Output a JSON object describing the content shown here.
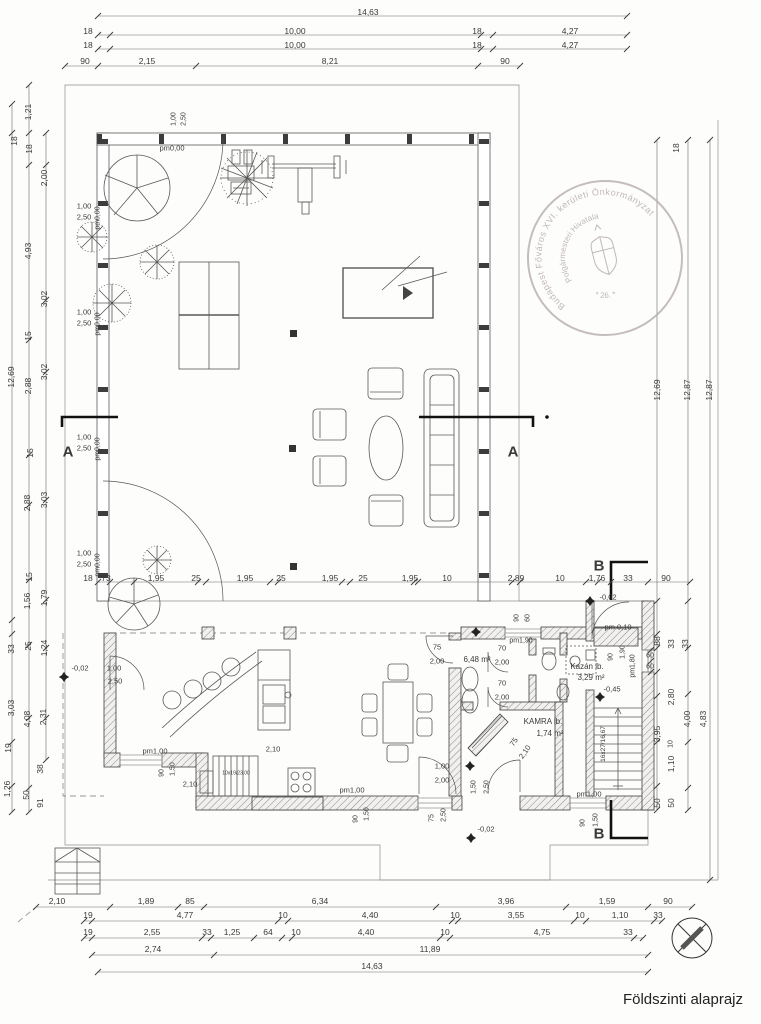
{
  "title": "Földszinti alaprajz",
  "stamp": {
    "ring_text": "Budapest Főváros XVI. kerületi Önkormányzat",
    "inner_text": "Polgármesteri Hivatala",
    "bottom_text": "* 26. *"
  },
  "rooms": {
    "bathroom_area": "6,48 m²",
    "boiler_label": "Kazán lb.",
    "boiler_area": "3,29 m²",
    "pantry_label": "KAMRA lb.",
    "pantry_area": "1,74 m²",
    "stair_main": "16x27/16,67",
    "stair_small": "10x19/23,00"
  },
  "labels": [
    {
      "t": "14,63",
      "x": 368,
      "y": 12
    },
    {
      "t": "18",
      "x": 88,
      "y": 31
    },
    {
      "t": "10,00",
      "x": 295,
      "y": 31
    },
    {
      "t": "18",
      "x": 477,
      "y": 31
    },
    {
      "t": "4,27",
      "x": 570,
      "y": 31
    },
    {
      "t": "18",
      "x": 88,
      "y": 45
    },
    {
      "t": "10,00",
      "x": 295,
      "y": 45
    },
    {
      "t": "18",
      "x": 477,
      "y": 45
    },
    {
      "t": "4,27",
      "x": 570,
      "y": 45
    },
    {
      "t": "90",
      "x": 85,
      "y": 61
    },
    {
      "t": "2,15",
      "x": 147,
      "y": 61
    },
    {
      "t": "8,21",
      "x": 330,
      "y": 61
    },
    {
      "t": "90",
      "x": 505,
      "y": 61
    },
    {
      "t": "1,21",
      "x": 28,
      "y": 112,
      "r": -90
    },
    {
      "t": "18",
      "x": 14,
      "y": 141,
      "r": -90
    },
    {
      "t": "18",
      "x": 29,
      "y": 149,
      "r": -90
    },
    {
      "t": "2,00",
      "x": 44,
      "y": 178,
      "r": -90
    },
    {
      "t": "4,93",
      "x": 28,
      "y": 251,
      "r": -90
    },
    {
      "t": "3,02",
      "x": 44,
      "y": 299,
      "r": -90
    },
    {
      "t": "15",
      "x": 28,
      "y": 336,
      "r": -90
    },
    {
      "t": "12,69",
      "x": 11,
      "y": 377,
      "r": -90
    },
    {
      "t": "2,88",
      "x": 28,
      "y": 386,
      "r": -90
    },
    {
      "t": "3,02",
      "x": 44,
      "y": 372,
      "r": -90
    },
    {
      "t": "15",
      "x": 30,
      "y": 453,
      "r": -90
    },
    {
      "t": "2,88",
      "x": 27,
      "y": 503,
      "r": -90
    },
    {
      "t": "3,03",
      "x": 44,
      "y": 500,
      "r": -90
    },
    {
      "t": "15",
      "x": 29,
      "y": 577,
      "r": -90
    },
    {
      "t": "1,56",
      "x": 27,
      "y": 601,
      "r": -90
    },
    {
      "t": "1,79",
      "x": 44,
      "y": 598,
      "r": -90
    },
    {
      "t": "33",
      "x": 11,
      "y": 649,
      "r": -90
    },
    {
      "t": "25",
      "x": 28,
      "y": 646,
      "r": -90
    },
    {
      "t": "1,24",
      "x": 44,
      "y": 648,
      "r": -90
    },
    {
      "t": "3,03",
      "x": 11,
      "y": 708,
      "r": -90
    },
    {
      "t": "4,08",
      "x": 27,
      "y": 719,
      "r": -90
    },
    {
      "t": "2,31",
      "x": 43,
      "y": 717,
      "r": -90
    },
    {
      "t": "19",
      "x": 8,
      "y": 748,
      "r": -90
    },
    {
      "t": "38",
      "x": 40,
      "y": 769,
      "r": -90
    },
    {
      "t": "1,26",
      "x": 7,
      "y": 789,
      "r": -90
    },
    {
      "t": "50",
      "x": 26,
      "y": 795,
      "r": -90
    },
    {
      "t": "91",
      "x": 40,
      "y": 803,
      "r": -90
    },
    {
      "t": "1,00",
      "x": 84,
      "y": 206,
      "s": 7.5
    },
    {
      "t": "2,50",
      "x": 84,
      "y": 217,
      "s": 7.5
    },
    {
      "t": "pm0,00",
      "x": 98,
      "y": 218,
      "r": -90,
      "s": 7
    },
    {
      "t": "1,00",
      "x": 84,
      "y": 312,
      "s": 7.5
    },
    {
      "t": "2,50",
      "x": 84,
      "y": 323,
      "s": 7.5
    },
    {
      "t": "pm0,00",
      "x": 98,
      "y": 324,
      "r": -90,
      "s": 7
    },
    {
      "t": "1,00",
      "x": 84,
      "y": 437,
      "s": 7.5
    },
    {
      "t": "2,50",
      "x": 84,
      "y": 448,
      "s": 7.5
    },
    {
      "t": "pm0,00",
      "x": 98,
      "y": 449,
      "r": -90,
      "s": 7
    },
    {
      "t": "1,00",
      "x": 84,
      "y": 553,
      "s": 7.5
    },
    {
      "t": "2,50",
      "x": 84,
      "y": 564,
      "s": 7.5
    },
    {
      "t": "pm0,00",
      "x": 98,
      "y": 565,
      "r": -90,
      "s": 7
    },
    {
      "t": "1,00",
      "x": 174,
      "y": 119,
      "r": -90,
      "s": 7
    },
    {
      "t": "2,50",
      "x": 184,
      "y": 119,
      "r": -90,
      "s": 7
    },
    {
      "t": "pm0,00",
      "x": 172,
      "y": 148,
      "s": 7.5
    },
    {
      "t": "18",
      "x": 676,
      "y": 148,
      "r": -90
    },
    {
      "t": "12,69",
      "x": 657,
      "y": 390,
      "r": -90
    },
    {
      "t": "12,87",
      "x": 687,
      "y": 390,
      "r": -90
    },
    {
      "t": "12,87",
      "x": 709,
      "y": 390,
      "r": -90
    },
    {
      "t": "18",
      "x": 88,
      "y": 578
    },
    {
      "t": "73",
      "x": 106,
      "y": 578
    },
    {
      "t": "1,95",
      "x": 156,
      "y": 578
    },
    {
      "t": "25",
      "x": 196,
      "y": 578
    },
    {
      "t": "1,95",
      "x": 245,
      "y": 578
    },
    {
      "t": "25",
      "x": 281,
      "y": 578
    },
    {
      "t": "1,95",
      "x": 330,
      "y": 578
    },
    {
      "t": "25",
      "x": 363,
      "y": 578
    },
    {
      "t": "1,95",
      "x": 410,
      "y": 578
    },
    {
      "t": "10",
      "x": 447,
      "y": 578
    },
    {
      "t": "2,89",
      "x": 516,
      "y": 578
    },
    {
      "t": "10",
      "x": 560,
      "y": 578
    },
    {
      "t": "1,76",
      "x": 597,
      "y": 578
    },
    {
      "t": "33",
      "x": 628,
      "y": 578
    },
    {
      "t": "90",
      "x": 666,
      "y": 578
    },
    {
      "t": "-0,02",
      "x": 608,
      "y": 597,
      "s": 7.5
    },
    {
      "t": "pm 0,10",
      "x": 618,
      "y": 627,
      "s": 7.5
    },
    {
      "t": "90",
      "x": 517,
      "y": 618,
      "r": -90,
      "s": 7
    },
    {
      "t": "60",
      "x": 528,
      "y": 618,
      "r": -90,
      "s": 7
    },
    {
      "t": "90",
      "x": 611,
      "y": 657,
      "r": -90,
      "s": 7
    },
    {
      "t": "1,90",
      "x": 623,
      "y": 652,
      "r": -90,
      "s": 7
    },
    {
      "t": "pm1,80",
      "x": 633,
      "y": 666,
      "r": -90,
      "s": 7
    },
    {
      "t": "88",
      "x": 657,
      "y": 641,
      "r": -90
    },
    {
      "t": "33",
      "x": 671,
      "y": 644,
      "r": -90
    },
    {
      "t": "33",
      "x": 685,
      "y": 644,
      "r": -90
    },
    {
      "t": "60",
      "x": 650,
      "y": 656,
      "s": 7
    },
    {
      "t": "60",
      "x": 650,
      "y": 667,
      "s": 7
    },
    {
      "t": "2,80",
      "x": 671,
      "y": 697,
      "r": -90
    },
    {
      "t": "4,00",
      "x": 687,
      "y": 719,
      "r": -90
    },
    {
      "t": "4,83",
      "x": 703,
      "y": 719,
      "r": -90
    },
    {
      "t": "3,95",
      "x": 657,
      "y": 734,
      "r": -90
    },
    {
      "t": "10",
      "x": 671,
      "y": 744,
      "r": -90,
      "s": 7
    },
    {
      "t": "1,10",
      "x": 671,
      "y": 764,
      "r": -90
    },
    {
      "t": "50",
      "x": 657,
      "y": 803,
      "r": -90
    },
    {
      "t": "50",
      "x": 671,
      "y": 803,
      "r": -90
    },
    {
      "t": "pm1,00",
      "x": 589,
      "y": 794,
      "s": 7.5
    },
    {
      "t": "90",
      "x": 583,
      "y": 823,
      "r": -90,
      "s": 7
    },
    {
      "t": "1,50",
      "x": 596,
      "y": 820,
      "r": -90,
      "s": 7
    },
    {
      "t": "16x27/16,67",
      "x": 604,
      "y": 744,
      "r": -90,
      "s": 6.5
    },
    {
      "t": "-0,45",
      "x": 612,
      "y": 689,
      "s": 7.5
    },
    {
      "t": "Kazán lb.",
      "x": 587,
      "y": 667,
      "s": 8
    },
    {
      "t": "3,29 m²",
      "x": 591,
      "y": 678,
      "s": 8
    },
    {
      "t": "KAMRA lb.",
      "x": 543,
      "y": 722,
      "s": 8
    },
    {
      "t": "1,74 m²",
      "x": 550,
      "y": 734,
      "s": 8
    },
    {
      "t": "75",
      "x": 514,
      "y": 742,
      "r": -55,
      "s": 7.5
    },
    {
      "t": "2,10",
      "x": 525,
      "y": 752,
      "r": -55,
      "s": 7.5
    },
    {
      "t": "75",
      "x": 437,
      "y": 647,
      "s": 7.5
    },
    {
      "t": "2,00",
      "x": 437,
      "y": 661,
      "s": 7.5
    },
    {
      "t": "6,48 m²",
      "x": 477,
      "y": 660,
      "s": 8
    },
    {
      "t": "70",
      "x": 502,
      "y": 648,
      "s": 7.5
    },
    {
      "t": "2,00",
      "x": 502,
      "y": 662,
      "s": 7.5
    },
    {
      "t": "pm1,90",
      "x": 521,
      "y": 641,
      "s": 7
    },
    {
      "t": "70",
      "x": 502,
      "y": 683,
      "s": 7.5
    },
    {
      "t": "2,00",
      "x": 502,
      "y": 697,
      "s": 7.5
    },
    {
      "t": "1,00",
      "x": 442,
      "y": 766,
      "s": 7.5
    },
    {
      "t": "2,00",
      "x": 442,
      "y": 780,
      "s": 7.5
    },
    {
      "t": "1,50",
      "x": 474,
      "y": 787,
      "r": -90,
      "s": 7
    },
    {
      "t": "2,50",
      "x": 487,
      "y": 787,
      "r": -90,
      "s": 7
    },
    {
      "t": "75",
      "x": 432,
      "y": 818,
      "r": -90,
      "s": 7
    },
    {
      "t": "2,50",
      "x": 444,
      "y": 815,
      "r": -90,
      "s": 7
    },
    {
      "t": "-0,02",
      "x": 486,
      "y": 829,
      "s": 7.5
    },
    {
      "t": "1,00",
      "x": 114,
      "y": 668,
      "s": 7.5
    },
    {
      "t": "2,50",
      "x": 115,
      "y": 681,
      "s": 7.5
    },
    {
      "t": "pm1,00",
      "x": 155,
      "y": 751,
      "s": 7.5
    },
    {
      "t": "90",
      "x": 162,
      "y": 773,
      "r": -90,
      "s": 7
    },
    {
      "t": "1,50",
      "x": 173,
      "y": 769,
      "r": -90,
      "s": 7
    },
    {
      "t": "2,10",
      "x": 190,
      "y": 784,
      "s": 7.5
    },
    {
      "t": "10x19/23,00",
      "x": 236,
      "y": 774,
      "s": 5
    },
    {
      "t": "2,10",
      "x": 273,
      "y": 749,
      "s": 7.5
    },
    {
      "t": "pm1,00",
      "x": 352,
      "y": 790,
      "s": 7.5
    },
    {
      "t": "90",
      "x": 356,
      "y": 819,
      "r": -90,
      "s": 7
    },
    {
      "t": "1,50",
      "x": 367,
      "y": 814,
      "r": -90,
      "s": 7
    },
    {
      "t": "-0,02",
      "x": 80,
      "y": 668,
      "s": 7.5
    },
    {
      "t": "A",
      "x": 68,
      "y": 452,
      "s": 15,
      "b": 1
    },
    {
      "t": "A",
      "x": 513,
      "y": 452,
      "s": 15,
      "b": 1
    },
    {
      "t": "B",
      "x": 599,
      "y": 566,
      "s": 15,
      "b": 1
    },
    {
      "t": "B",
      "x": 599,
      "y": 834,
      "s": 15,
      "b": 1
    },
    {
      "t": "2,10",
      "x": 57,
      "y": 901
    },
    {
      "t": "1,89",
      "x": 146,
      "y": 901
    },
    {
      "t": "85",
      "x": 190,
      "y": 901
    },
    {
      "t": "6,34",
      "x": 320,
      "y": 901
    },
    {
      "t": "3,96",
      "x": 506,
      "y": 901
    },
    {
      "t": "1,59",
      "x": 607,
      "y": 901
    },
    {
      "t": "90",
      "x": 668,
      "y": 901
    },
    {
      "t": "19",
      "x": 88,
      "y": 915
    },
    {
      "t": "4,77",
      "x": 185,
      "y": 915
    },
    {
      "t": "10",
      "x": 283,
      "y": 915
    },
    {
      "t": "4,40",
      "x": 370,
      "y": 915
    },
    {
      "t": "10",
      "x": 455,
      "y": 915
    },
    {
      "t": "3,55",
      "x": 516,
      "y": 915
    },
    {
      "t": "10",
      "x": 580,
      "y": 915
    },
    {
      "t": "1,10",
      "x": 620,
      "y": 915
    },
    {
      "t": "33",
      "x": 658,
      "y": 915
    },
    {
      "t": "19",
      "x": 88,
      "y": 932
    },
    {
      "t": "2,55",
      "x": 152,
      "y": 932
    },
    {
      "t": "33",
      "x": 207,
      "y": 932
    },
    {
      "t": "1,25",
      "x": 232,
      "y": 932
    },
    {
      "t": "64",
      "x": 268,
      "y": 932
    },
    {
      "t": "10",
      "x": 296,
      "y": 932
    },
    {
      "t": "4,40",
      "x": 366,
      "y": 932
    },
    {
      "t": "10",
      "x": 445,
      "y": 932
    },
    {
      "t": "4,75",
      "x": 542,
      "y": 932
    },
    {
      "t": "33",
      "x": 628,
      "y": 932
    },
    {
      "t": "2,74",
      "x": 153,
      "y": 949
    },
    {
      "t": "11,89",
      "x": 430,
      "y": 949
    },
    {
      "t": "14,63",
      "x": 372,
      "y": 966
    }
  ]
}
